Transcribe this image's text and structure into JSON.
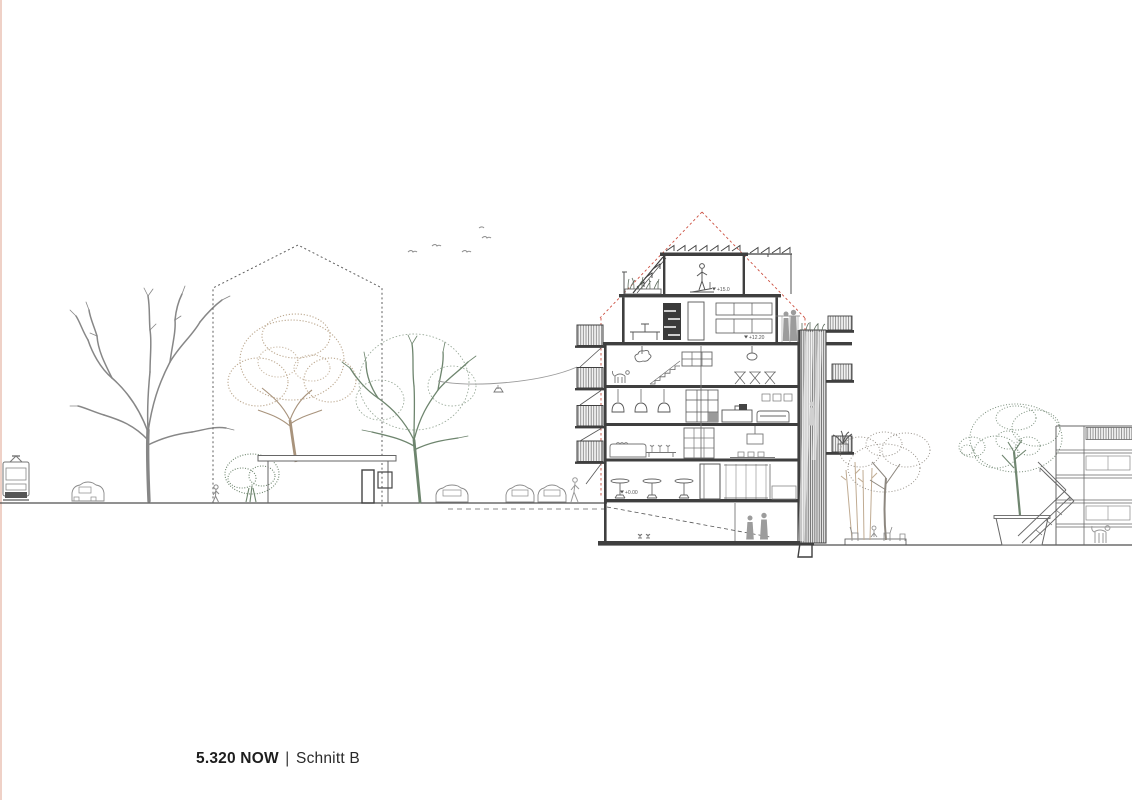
{
  "caption": {
    "code": "5.320 NOW",
    "separator": "|",
    "title": "Schnitt B"
  },
  "annotations": {
    "elevation_markers": [
      {
        "label": "+15.0"
      },
      {
        "label": "+12.20"
      },
      {
        "label": "+0.00"
      }
    ]
  },
  "colors": {
    "linework": "#4d4d4d",
    "winter_tree_gray": "#878787",
    "autumn_tree_tan": "#bca88f",
    "green_tree": "#6e856e",
    "roof_envelope_red": "#cc4f40",
    "page_edge_pink": "#ecc9bd",
    "background": "#ffffff"
  }
}
